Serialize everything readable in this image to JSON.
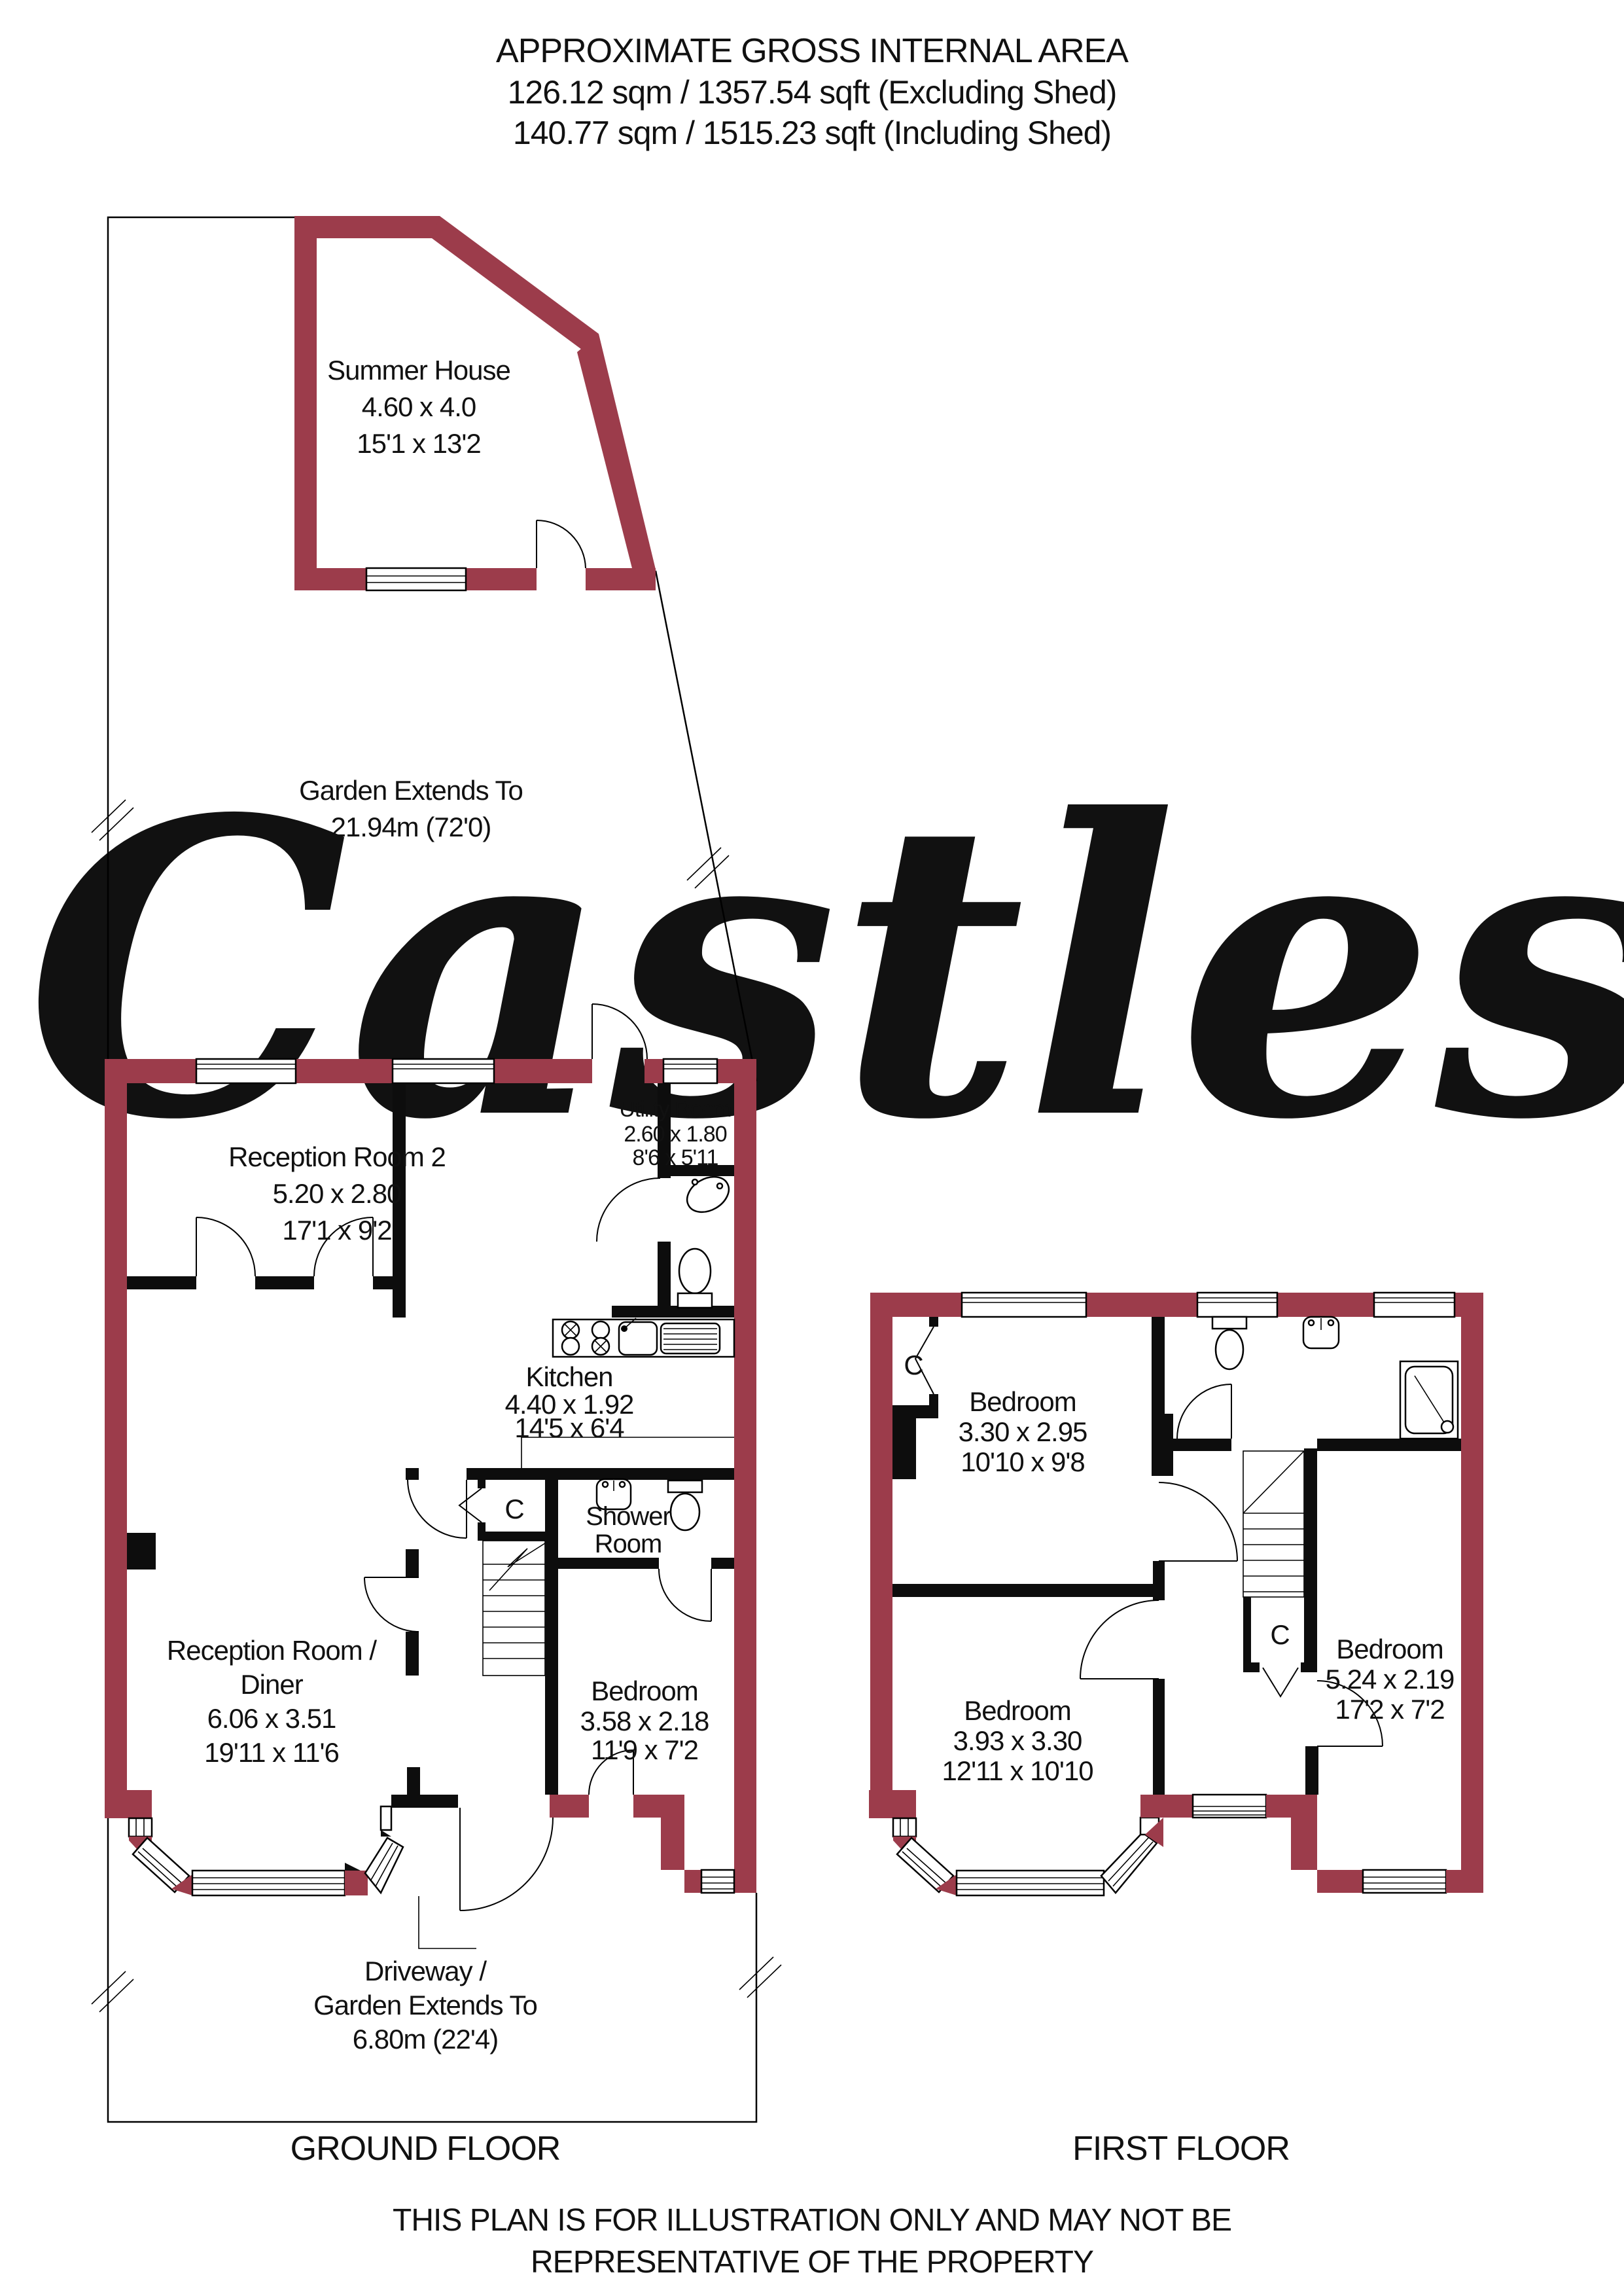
{
  "header": {
    "line1": "APPROXIMATE GROSS INTERNAL AREA",
    "line2": "126.12 sqm / 1357.54 sqft (Excluding Shed)",
    "line3": "140.77 sqm / 1515.23 sqft (Including Shed)"
  },
  "watermark": {
    "text": "Castles",
    "color": "#e9e9e9"
  },
  "garden": {
    "line1": "Garden Extends To",
    "line2": "21.94m (72'0)"
  },
  "summer_house": {
    "name": "Summer House",
    "dim_m": "4.60 x 4.0",
    "dim_ft": "15'1 x 13'2"
  },
  "ground_floor": {
    "title": "GROUND FLOOR",
    "reception2": {
      "name": "Reception Room 2",
      "dim_m": "5.20 x 2.80",
      "dim_ft": "17'1 x 9'2"
    },
    "utility": {
      "name": "Utility Room",
      "dim_m": "2.60 x 1.80",
      "dim_ft": "8'6 x 5'11"
    },
    "kitchen": {
      "name": "Kitchen",
      "dim_m": "4.40 x 1.92",
      "dim_ft": "14'5 x 6'4"
    },
    "reception_diner": {
      "name1": "Reception Room /",
      "name2": "Diner",
      "dim_m": "6.06 x 3.51",
      "dim_ft": "19'11 x 11'6"
    },
    "shower": {
      "name1": "Shower",
      "name2": "Room"
    },
    "bedroom": {
      "name": "Bedroom",
      "dim_m": "3.58 x 2.18",
      "dim_ft": "11'9 x 7'2"
    },
    "closet": "C",
    "driveway": {
      "line1": "Driveway /",
      "line2": "Garden Extends To",
      "line3": "6.80m (22'4)"
    }
  },
  "first_floor": {
    "title": "FIRST FLOOR",
    "bedroom_top": {
      "name": "Bedroom",
      "dim_m": "3.30 x 2.95",
      "dim_ft": "10'10 x 9'8"
    },
    "bedroom_left": {
      "name": "Bedroom",
      "dim_m": "3.93 x 3.30",
      "dim_ft": "12'11 x 10'10"
    },
    "bedroom_right": {
      "name": "Bedroom",
      "dim_m": "5.24 x 2.19",
      "dim_ft": "17'2 x 7'2"
    },
    "closet_top": "C",
    "closet_mid": "C"
  },
  "disclaimer": {
    "line1": "THIS PLAN IS FOR ILLUSTRATION ONLY AND MAY NOT BE",
    "line2": "REPRESENTATIVE OF THE PROPERTY"
  },
  "colors": {
    "wall": "#9c3c4b",
    "interior_wall": "#0d0d0d",
    "watermark": "#e9e9e9"
  }
}
